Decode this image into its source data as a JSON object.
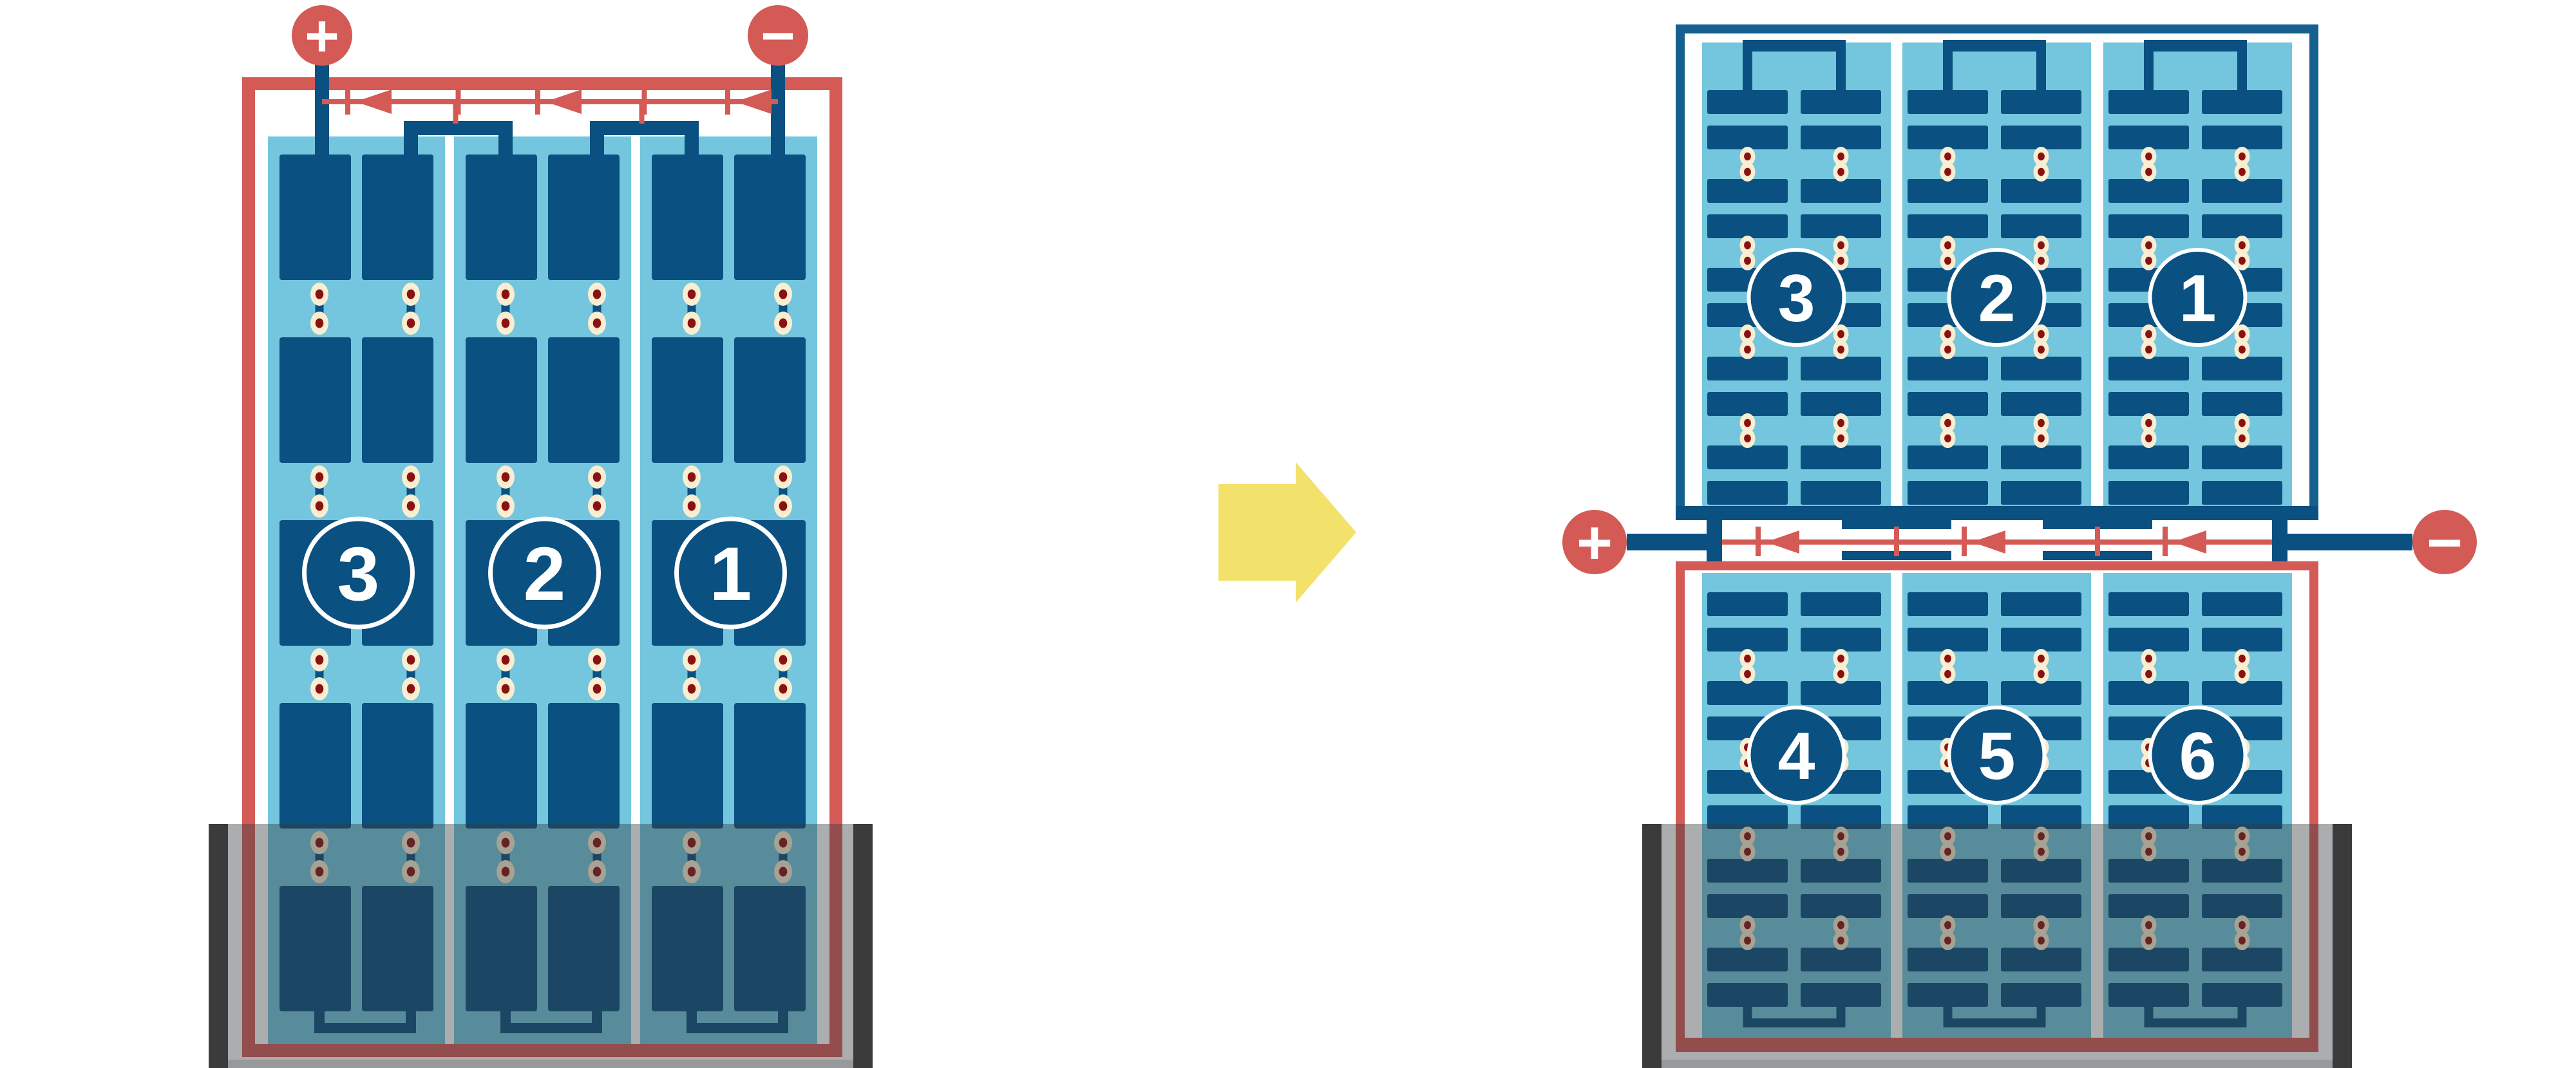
{
  "diagram": {
    "left_battery": {
      "terminals": {
        "positive": "+",
        "negative": "−"
      },
      "cell_labels": [
        "3",
        "2",
        "1"
      ]
    },
    "right_battery": {
      "terminals": {
        "positive": "+",
        "negative": "−"
      },
      "top_panel": {
        "cell_labels": [
          "3",
          "2",
          "1"
        ]
      },
      "bottom_panel": {
        "cell_labels": [
          "4",
          "5",
          "6"
        ]
      }
    },
    "transform_arrow": {
      "direction": "right"
    },
    "colors": {
      "plate_navy": "#0a5080",
      "frame_blue": "#14608f",
      "cell_light_blue": "#73c6dd",
      "wire_red": "#d45a56",
      "rivet_cream": "#f9edd2",
      "rivet_core_red": "#8b1111",
      "arrow_yellow": "#f2e16b",
      "tray_bar_dark": "#3b3b3b",
      "tray_overlay": "rgba(55,60,62,0.42)",
      "tray_rim_gray": "#97999a",
      "terminal_sign_white": "#ffffff"
    }
  }
}
